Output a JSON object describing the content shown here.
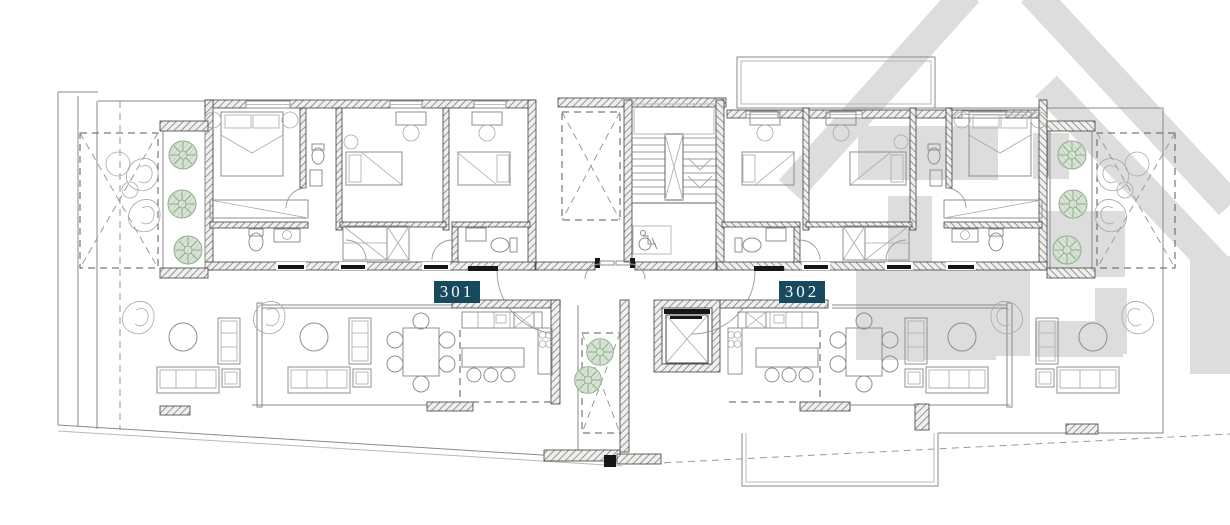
{
  "units": [
    {
      "id": "unit-301",
      "label": "301"
    },
    {
      "id": "unit-302",
      "label": "302"
    }
  ],
  "watermark_icon": "house-roof-logo",
  "colors": {
    "label-bg": "#17495F",
    "label-text": "#FFFFFF",
    "tree-fill": "#D9E4D6",
    "tree-stroke": "#8FAE8C",
    "watermark": "#BDBDBD",
    "wall-line": "#3F3F3F",
    "furn": "#8F8F8F"
  }
}
